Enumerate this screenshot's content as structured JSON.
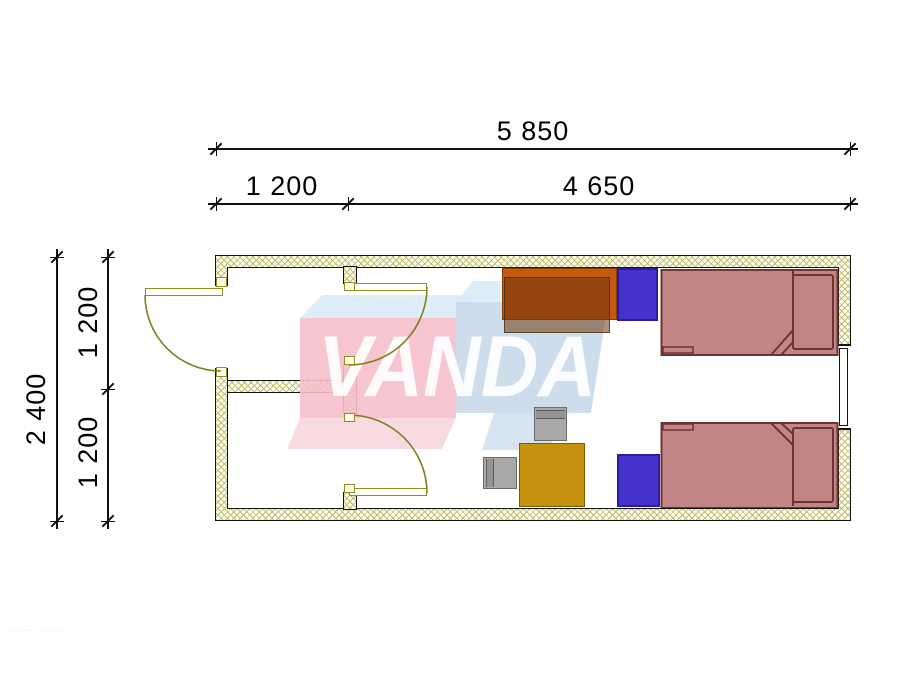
{
  "logo": {
    "text": "VANDA"
  },
  "dimensions": {
    "top_total": "5 850",
    "top_left": "1 200",
    "top_right": "4 650",
    "side_total": "2 400",
    "side_upper": "1 200",
    "side_lower": "1 200"
  },
  "fine_print": "·· ····· ······· ··· ··· ···",
  "colors": {
    "wall_hatch": "#baba68",
    "door_olive": "#8f8f22",
    "bed_fill": "#c18585",
    "bed_outline": "#6d3434",
    "nightstand_blue": "#4531cb",
    "desk_orange": "#c35a0f",
    "desk_brown_overlay": "#6e370f",
    "table_gold": "#c6920e",
    "chair_gray": "#a8a8a8",
    "logo_pink": "#f5bfca",
    "logo_blue": "#c9d9ea",
    "logo_pale": "#d8ecf8"
  }
}
